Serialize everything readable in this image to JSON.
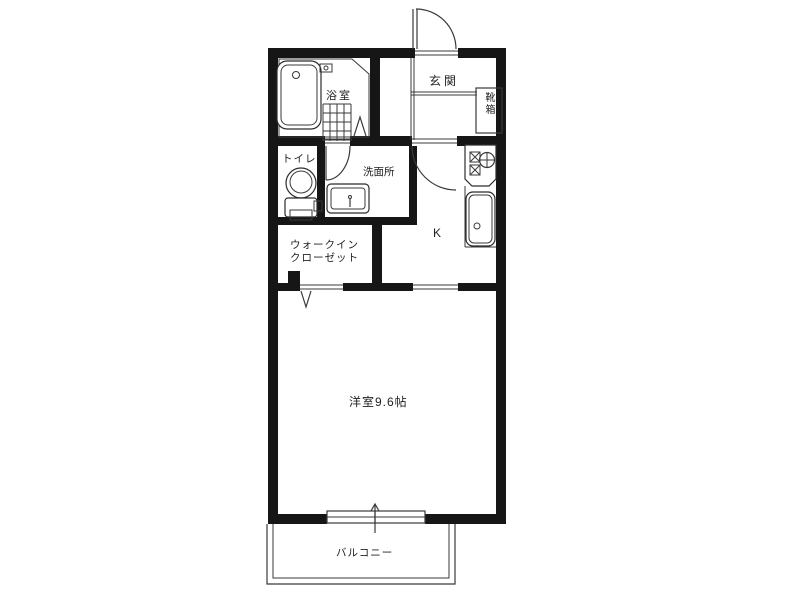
{
  "diagram_type": "apartment-floor-plan",
  "rooms": {
    "bathroom": "浴室",
    "entrance": "玄関",
    "shoe_box": "靴箱",
    "toilet": "トイレ",
    "washroom": "洗面所",
    "kitchen": "K",
    "closet_line1": "ウォークイン",
    "closet_line2": "クローゼット",
    "main_room": "洋室9.6帖",
    "balcony": "バルコニー"
  },
  "colors": {
    "wall": "#161616",
    "line": "#3a3a3a",
    "background": "#ffffff",
    "text": "#222222"
  }
}
